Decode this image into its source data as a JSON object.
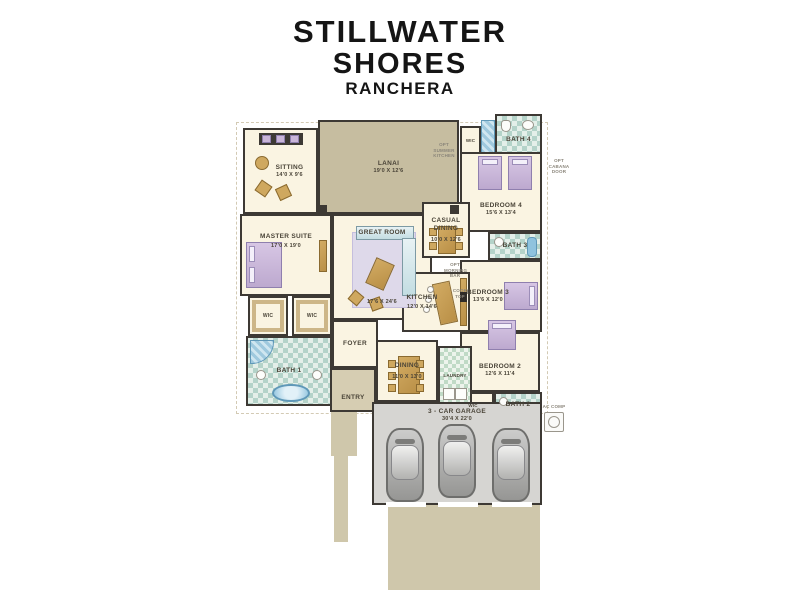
{
  "title": {
    "line1": "STILLWATER",
    "line2": "SHORES",
    "line3": "RANCHERA"
  },
  "plan": {
    "sitting": {
      "label": "SITTING",
      "dims": "14'0 X 9'6"
    },
    "lanai": {
      "label": "LANAI",
      "dims": "19'0 X 12'6"
    },
    "master_suite": {
      "label": "MASTER SUITE",
      "dims": "17'0 X 19'0"
    },
    "great_room": {
      "label": "GREAT ROOM",
      "dims": "17'6 X 24'6"
    },
    "casual_dining": {
      "label": "CASUAL DINING",
      "dims": "10'0 X 12'6"
    },
    "kitchen": {
      "label": "KITCHEN",
      "dims": "12'0 X 14'6"
    },
    "dining": {
      "label": "DINING",
      "dims": "11'0 X 13'0"
    },
    "foyer": {
      "label": "FOYER"
    },
    "entry": {
      "label": "ENTRY"
    },
    "laundry": {
      "label": "LAUNDRY"
    },
    "bath1": {
      "label": "BATH 1"
    },
    "bath2": {
      "label": "BATH 2"
    },
    "bath3": {
      "label": "BATH 3"
    },
    "bath4": {
      "label": "BATH 4"
    },
    "bedroom2": {
      "label": "BEDROOM 2",
      "dims": "12'6 X 11'4"
    },
    "bedroom3": {
      "label": "BEDROOM 3",
      "dims": "13'6 X 12'0"
    },
    "bedroom4": {
      "label": "BEDROOM 4",
      "dims": "15'6 X 13'4"
    },
    "garage": {
      "label": "3 - CAR GARAGE",
      "dims": "30'4 X 22'0"
    },
    "wic": {
      "label": "WIC"
    },
    "ac_comp": {
      "label": "AC COMP"
    }
  },
  "notes": {
    "opt_summer_kitchen": "OPT SUMMER KITCHEN",
    "opt_cabana_door": "OPT CABANA DOOR",
    "opt_morning_bar": "OPT MORNING BAR",
    "cook_top": "COOK TOP"
  },
  "colors": {
    "wall": "#3d3934",
    "floor": "#faf4e2",
    "lanai": "#c6bda0",
    "driveway": "#cfc7ab",
    "garage_floor": "#d6d5d2",
    "bath_tile": "#b4d3c9",
    "bed_accent": "#c9b5d8",
    "wood": "#c2994f"
  }
}
